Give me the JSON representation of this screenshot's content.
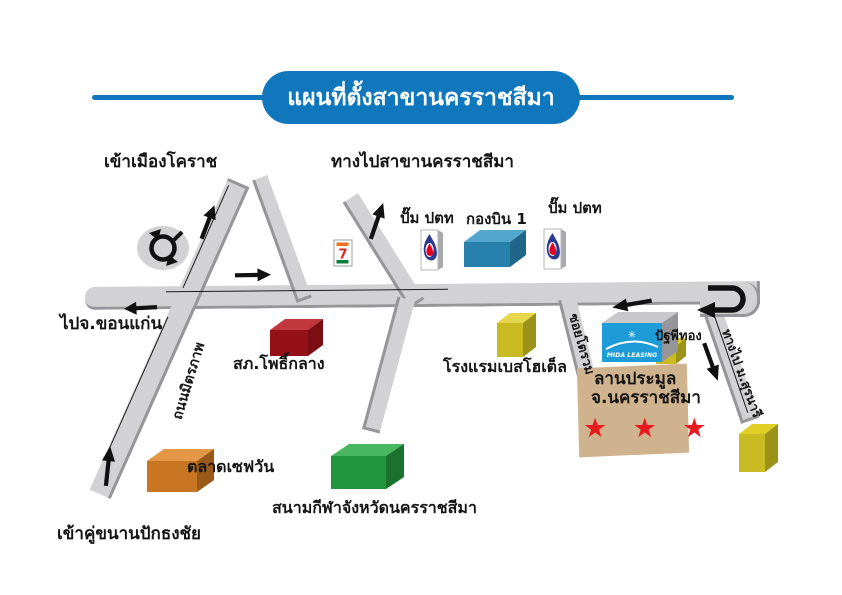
{
  "title": {
    "text": "แผนที่ตั้งสาขานครราชสีมา"
  },
  "directions": {
    "enter_korat": "เข้าเมืองโคราช",
    "to_branch": "ทางไปสาขานครราชสีมา",
    "to_khon_kaen": "ไปจ.ขอนแก่น",
    "enter_pak_thong_chai": "เข้าคู่ขนานปักธงชัย"
  },
  "roads": {
    "mittraphap": "ถนนมิตรภาพ",
    "soi": "ซอยโตรวม",
    "to_suranaree": "ทางไป ม.สุรนารี"
  },
  "places": {
    "ptt_pump_left": "ปั๊ม ปตท",
    "ptt_pump_right": "ปั๊ม ปตท",
    "wing_1": "กองบิน 1",
    "pho_klang_police": "สภ.โพธิ์กลาง",
    "best_hotel": "โรงแรมเบสโฮเต็ล",
    "save_one_market": "ตลาดเซฟวัน",
    "provincial_stadium": "สนามกีฬาจังหวัดนครราชสีมา",
    "patthaphi_thong": "ปัฐพีทอง",
    "auction_yard_line1": "ลานประมูล",
    "auction_yard_line2": "จ.นครราชสีมา",
    "auction_stars": "★ ★ ★",
    "branch_sign": "MIDA LEASING",
    "branch_logo": "✳",
    "seven_eleven": "7"
  },
  "colors": {
    "title_blue": "#1177bd",
    "road_gray": "#d2d2d4",
    "road_shadow": "#96969a",
    "police_red": "#b5161d",
    "wing1_blue": "#2e93c4",
    "hotel_yellow": "#e0d025",
    "market_orange": "#e08426",
    "stadium_green": "#27a844",
    "auction_tan": "#cfb28e",
    "star_red": "#e8191f",
    "mida_blue": "#1e9cd7",
    "ptt_blue": "#2a3b8f",
    "ptt_red": "#e6001e",
    "seven_green": "#0a7d3c",
    "seven_orange": "#f06f20",
    "seven_red": "#d9261c"
  }
}
